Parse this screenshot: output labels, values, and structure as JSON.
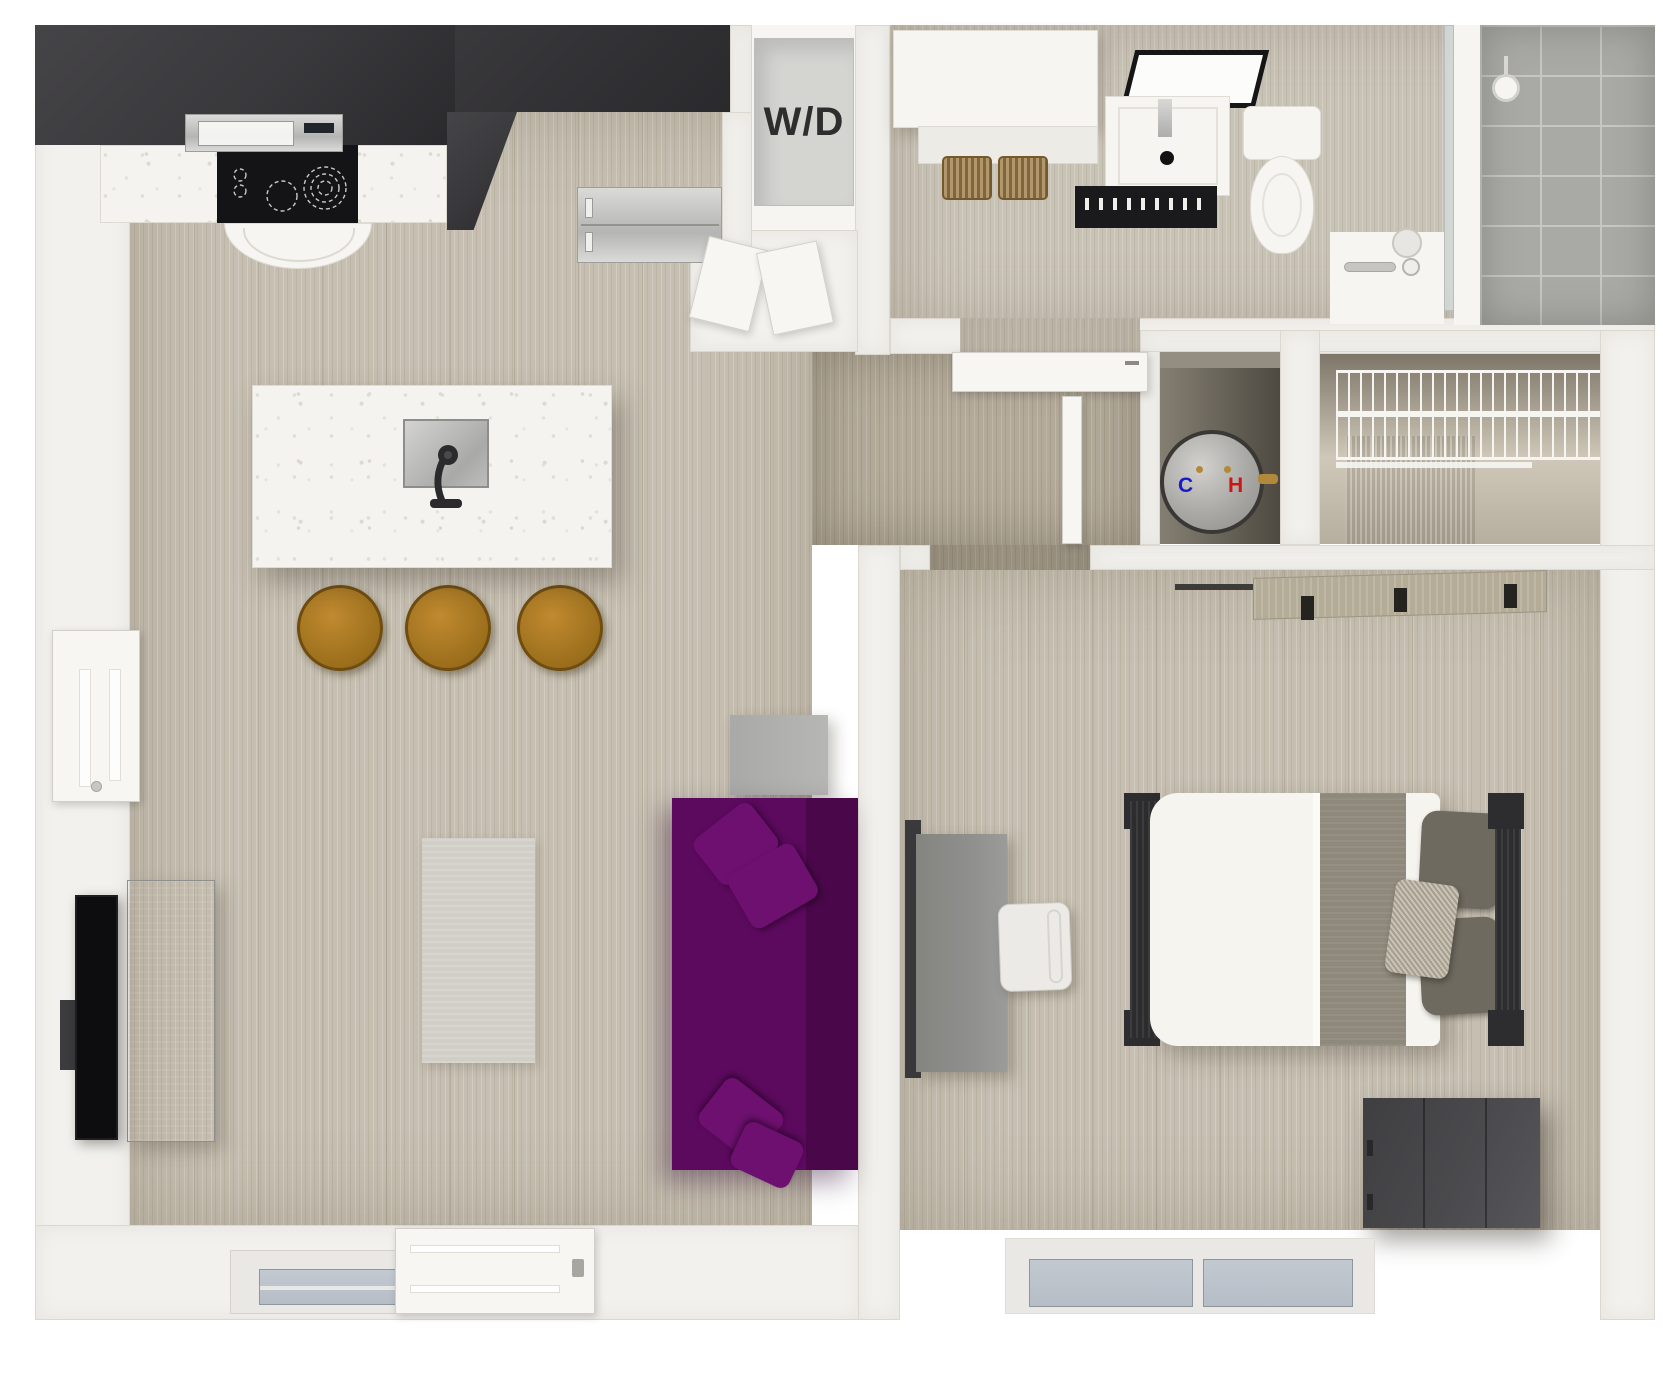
{
  "labels": {
    "washer_dryer": "W/D",
    "water_heater_cold": "C",
    "water_heater_hot": "H"
  },
  "colors": {
    "wall": "#f2f1ed",
    "wall-line": "#dcd8d0",
    "floor-wood": "#c6bfb1",
    "floor-wood-dark": "#b3aa9a",
    "floor-bath": "#c9c3b6",
    "cabinet-dark": "#39383b",
    "counter-quartz": "#f4f3ef",
    "cooktop": "#141316",
    "stainless-hi": "#dadad8",
    "stainless-lo": "#b5b5b3",
    "appliance-gray": "#d4d4d1",
    "label-dark": "#2e2e2e",
    "cold-blue": "#1a1acd",
    "hot-red": "#cf1414",
    "sofa-purple": "#5c0a5e",
    "sofa-purple-dark": "#4a084b",
    "pillow-purple": "#6e1070",
    "rug": "#d0cec6",
    "table-gray": "#b6b6b4",
    "tv-black": "#0d0d0f",
    "console-gray": "#a7a8a6",
    "bed-white": "#f6f4ef",
    "blanket": "#8e897b",
    "pillow-gray": "#6f6a60",
    "pillow-accent": "#b7b09f",
    "frame-dark": "#2d2c2e",
    "dresser": "#4a4a4d",
    "desk": "#8f908e",
    "chair-white": "#eceae6",
    "wood-shelf": "#b4ac97",
    "rod-dark": "#3e3c39",
    "heater-gray": "#a9a8a5",
    "closet-beige": "#c8c1b2",
    "wardrobe": "#5a5146",
    "wire-white": "#f6f5f2",
    "tile": "#a9a9a5",
    "grout": "#c6c6c2",
    "glass": "#b6bdc6",
    "window-frame": "#e9e8e4",
    "porcelain": "#f6f5f1",
    "basket": "#9a7a46",
    "stool": "#9c6f1c",
    "door-white": "#f7f6f3",
    "brass": "#b08a3a"
  },
  "objects": [
    "kitchen-upper-cabinets",
    "cooktop",
    "microwave",
    "range-hood",
    "refrigerator",
    "kitchen-island",
    "island-sink",
    "island-faucet",
    "bar-stools",
    "washer-dryer-closet",
    "washer-dryer-unit",
    "bathroom-counter",
    "storage-baskets",
    "bathroom-mirror",
    "bathroom-vanity",
    "toilet",
    "walk-in-shower",
    "shower-head",
    "water-heater",
    "wire-shelf-closet",
    "wardrobe",
    "sofa",
    "throw-pillows",
    "area-rug",
    "side-table",
    "tv",
    "media-console",
    "left-closet-door",
    "entry-door",
    "living-room-window",
    "bed",
    "bed-pillows",
    "desk",
    "desk-chair",
    "dresser",
    "closet-rod-shelf",
    "bedroom-window",
    "bathroom-door"
  ]
}
